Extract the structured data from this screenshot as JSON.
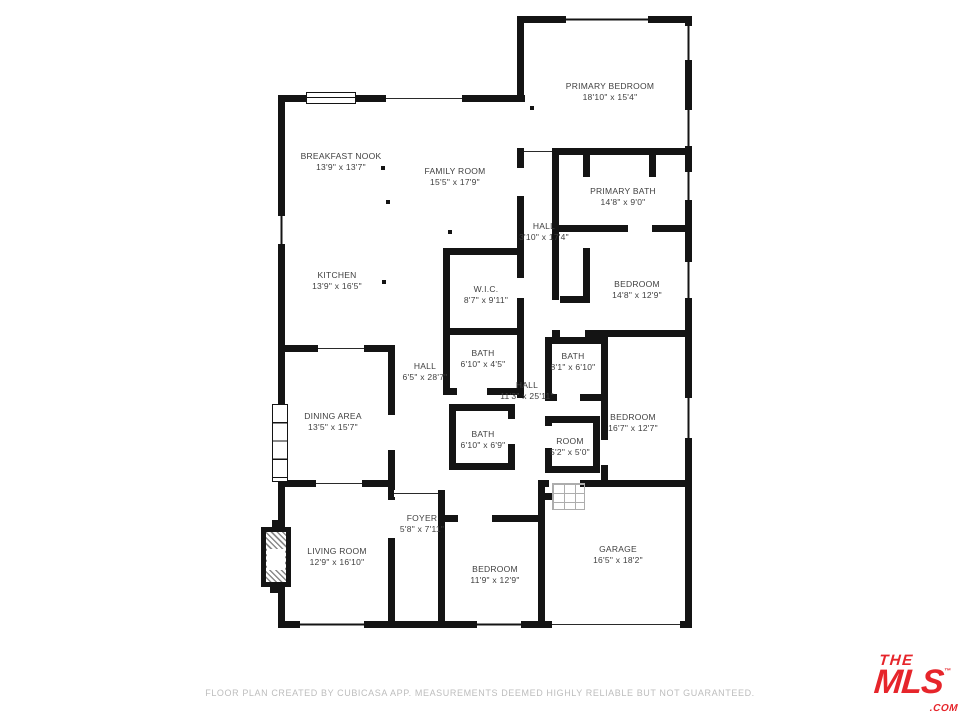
{
  "floorplan": {
    "rooms": [
      {
        "name": "BREAKFAST NOOK",
        "dims": "13'9\" x 13'7\""
      },
      {
        "name": "FAMILY ROOM",
        "dims": "15'5\" x 17'9\""
      },
      {
        "name": "PRIMARY BEDROOM",
        "dims": "18'10\" x 15'4\""
      },
      {
        "name": "PRIMARY BATH",
        "dims": "14'8\" x 9'0\""
      },
      {
        "name": "HALL",
        "dims": "3'10\" x 17'4\""
      },
      {
        "name": "BEDROOM",
        "dims": "14'8\" x 12'9\""
      },
      {
        "name": "W.I.C.",
        "dims": "8'7\" x 9'11\""
      },
      {
        "name": "BATH",
        "dims": "6'10\" x 4'5\""
      },
      {
        "name": "HALL",
        "dims": "6'5\" x 28'7\""
      },
      {
        "name": "BATH",
        "dims": "8'1\" x 6'10\""
      },
      {
        "name": "HALL",
        "dims": "11'3\" x 25'11\""
      },
      {
        "name": "KITCHEN",
        "dims": "13'9\" x 16'5\""
      },
      {
        "name": "DINING AREA",
        "dims": "13'5\" x 15'7\""
      },
      {
        "name": "BEDROOM",
        "dims": "16'7\" x 12'7\""
      },
      {
        "name": "BATH",
        "dims": "6'10\" x 6'9\""
      },
      {
        "name": "ROOM",
        "dims": "5'2\" x 5'0\""
      },
      {
        "name": "FOYER",
        "dims": "5'8\" x 7'11\""
      },
      {
        "name": "LIVING ROOM",
        "dims": "12'9\" x 16'10\""
      },
      {
        "name": "BEDROOM",
        "dims": "11'9\" x 12'9\""
      },
      {
        "name": "GARAGE",
        "dims": "16'5\" x 18'2\""
      }
    ],
    "footer": "FLOOR PLAN CREATED BY CUBICASA APP. MEASUREMENTS DEEMED HIGHLY RELIABLE BUT NOT GUARANTEED.",
    "logo": {
      "line1": "THE",
      "line2": "MLS",
      "tm": "™",
      "suffix": ".COM",
      "color": "#e6252b"
    }
  }
}
